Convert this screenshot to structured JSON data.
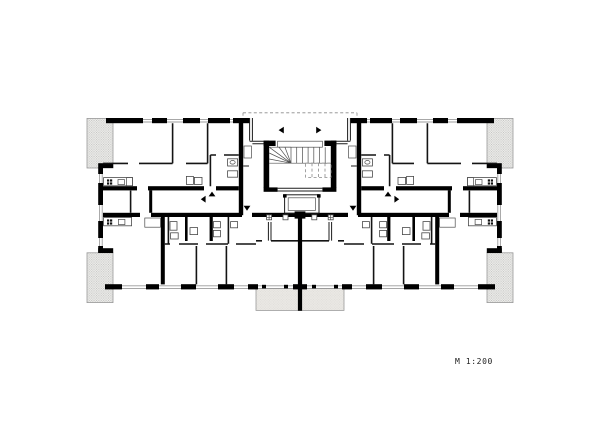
{
  "page": {
    "background_color": "#ffffff",
    "width_px": 600,
    "height_px": 424
  },
  "drawing": {
    "kind": "architectural-floor-plan",
    "scale_label": "M 1:200",
    "ink_color": "#1c1c1c",
    "wall_color": "#000000",
    "window_line_color": "#9b9b9b",
    "balcony_hatch_fill": "#ececea",
    "balcony_hatch_dot": "#bdbdbb",
    "balcony_plain_fill": "#eae8e4",
    "features": {
      "corner_balconies": 4,
      "rear_balconies": 2,
      "stair": "central winder stair",
      "elevator": "central shaft below stair",
      "canopy": "dashed roof outline over entrance recess"
    }
  }
}
